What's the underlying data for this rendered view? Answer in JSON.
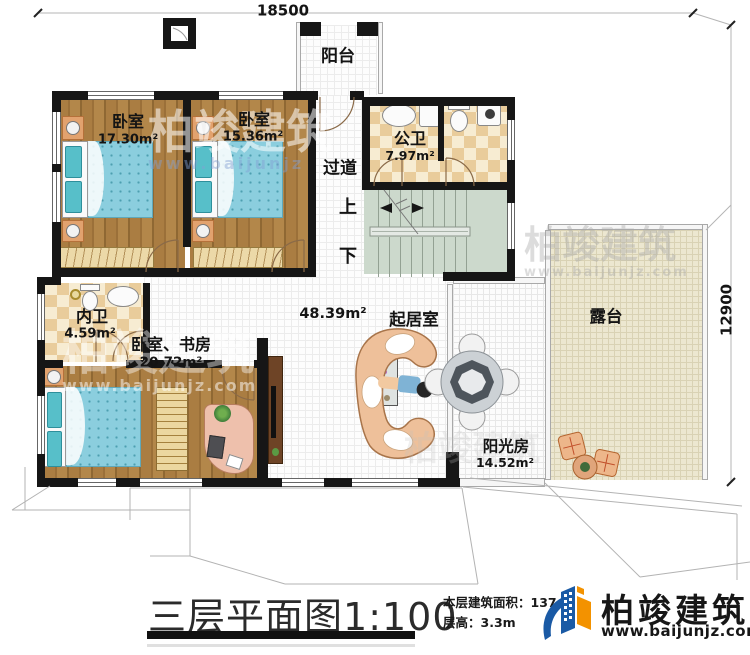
{
  "dimensions": {
    "width_mm": "18500",
    "height_mm": "12900"
  },
  "rooms": {
    "balcony": {
      "name": "阳台"
    },
    "bedroom1": {
      "name": "卧室",
      "area": "17.30m²"
    },
    "bedroom2": {
      "name": "卧室",
      "area": "15.36m²"
    },
    "public_bath": {
      "name": "公卫",
      "area": "7.97m²"
    },
    "corridor": {
      "name": "过道"
    },
    "stair_up": {
      "name": "上"
    },
    "stair_down": {
      "name": "下"
    },
    "inner_bath": {
      "name": "内卫",
      "area": "4.59m²"
    },
    "study_bedroom": {
      "name": "卧室、书房",
      "area": "20.72m²"
    },
    "living": {
      "name": "起居室",
      "area": "48.39m²"
    },
    "sunroom": {
      "name": "阳光房",
      "area": "14.52m²"
    },
    "terrace": {
      "name": "露台"
    }
  },
  "footer": {
    "title": "三层平面图",
    "scale": "1:100",
    "floor_area_label": "本层建筑面积：",
    "floor_area_value": "137.2",
    "floor_height_label": "层高：",
    "floor_height_value": "3.3m"
  },
  "brand": {
    "company": "柏竣建筑",
    "website": "www.baijunjz.com"
  },
  "watermark": {
    "company": "柏竣建筑",
    "website": "www.baijunjz.com",
    "website_short": "www.baijunjz"
  },
  "colors": {
    "wall": "#161616",
    "wood": "#a87c42",
    "bed_blue": "#8bcede",
    "tile": "#e9cc9b",
    "stairs": "#ccd9cc",
    "terrace": "#ebe6d0",
    "brand_blue": "#1a5aa5",
    "brand_orange": "#f39200"
  }
}
